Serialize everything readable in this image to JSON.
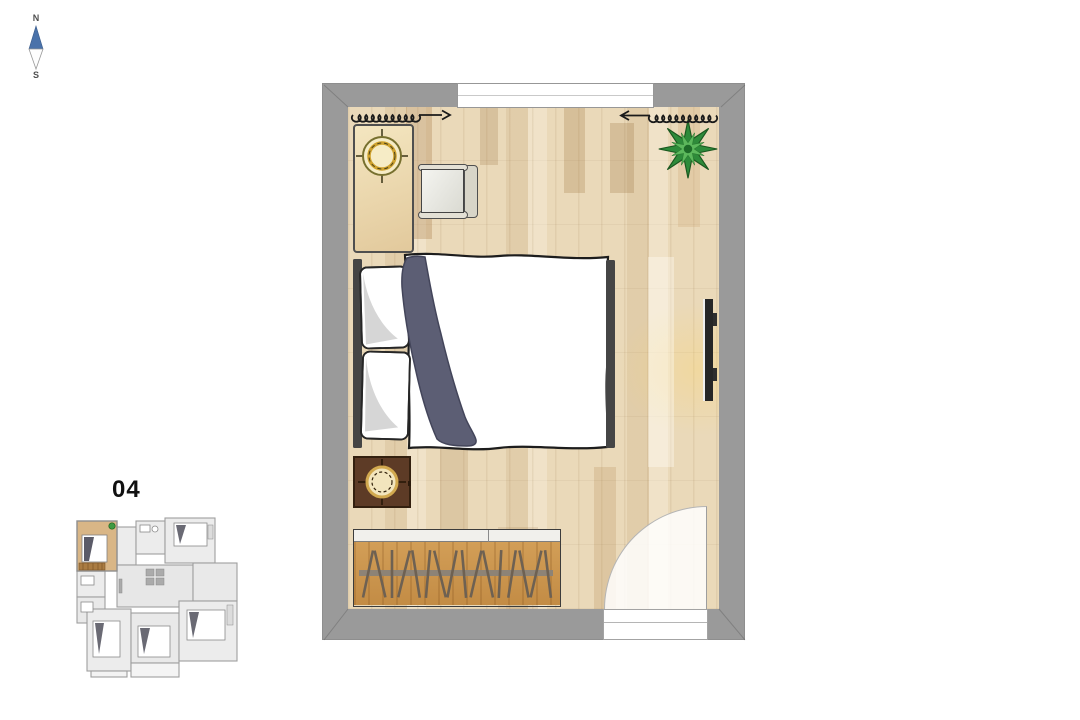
{
  "page": {
    "background_color": "#ffffff"
  },
  "compass": {
    "north_label": "N",
    "south_label": "S",
    "needle_north_color": "#4a72aa",
    "needle_south_color": "#ffffff"
  },
  "overview_plan": {
    "unit_number": "04",
    "highlight_room_color": "#d9b686",
    "room_fill_color": "#ececec",
    "wall_color": "#9e9e9e"
  },
  "main_plan": {
    "wall_color": "#9a9a9a",
    "floor_base_color": "#ead9b9",
    "window_color": "#ffffff",
    "door_swing_color": "rgba(255,255,255,0.84)",
    "curtain_symbol_color": "#1a1a1a",
    "furniture": [
      {
        "name": "desk",
        "fill": "#eeddb4"
      },
      {
        "name": "desk-chair",
        "fill": "#e3e0d5"
      },
      {
        "name": "ceiling-light-symbol",
        "ring_color": "#cfa22e"
      },
      {
        "name": "potted-plant",
        "leaf_color": "#2e8b3a"
      },
      {
        "name": "double-bed",
        "duvet_color": "#ffffff",
        "blanket_color": "#5c5e74",
        "frame_color": "#454545"
      },
      {
        "name": "wall-tv",
        "fill": "#262626"
      },
      {
        "name": "nightstand",
        "fill": "#5d3b26",
        "lamp_ring_color": "#d2a94f"
      },
      {
        "name": "wardrobe",
        "fill": "#cf9a52",
        "rail_color": "#8d8376"
      }
    ]
  }
}
